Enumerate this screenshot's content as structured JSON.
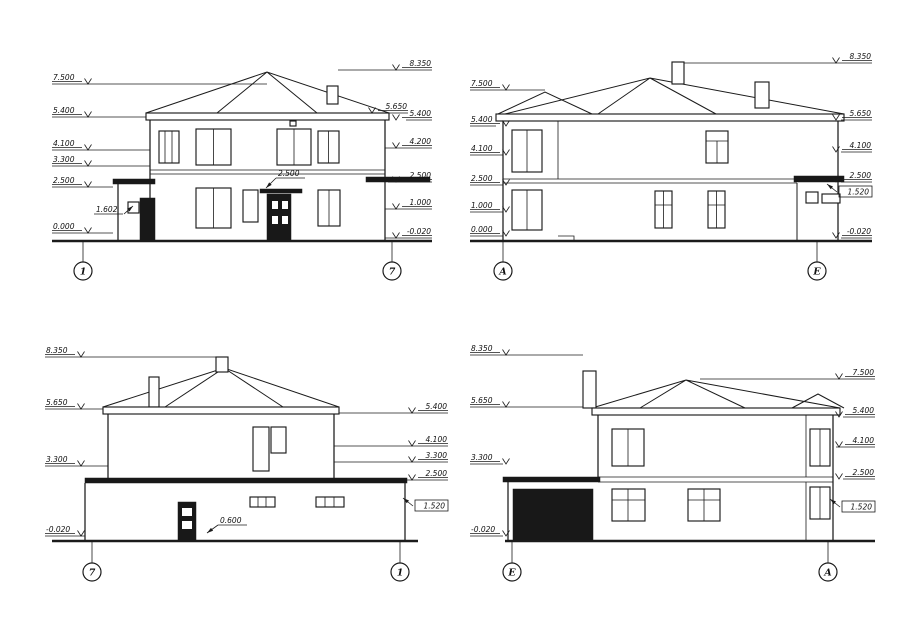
{
  "drawing": {
    "colors": {
      "line": "#1b1b1b",
      "background": "#ffffff"
    },
    "elevations": [
      {
        "id": "front-facade-1-7",
        "axes": [
          "1",
          "7"
        ],
        "marks_left": [
          "7.500",
          "5.400",
          "4.100",
          "3.300",
          "2.500",
          "0.000"
        ],
        "marks_right": [
          "8.350",
          "5.650",
          "5.400",
          "4.200",
          "2.500",
          "1.000",
          "-0.020"
        ],
        "notes": [
          "1.602",
          "2.500"
        ]
      },
      {
        "id": "side-facade-A-E",
        "axes": [
          "А",
          "Е"
        ],
        "marks_left": [
          "7.500",
          "5.400",
          "4.100",
          "2.500",
          "1.000",
          "0.000"
        ],
        "marks_right": [
          "8.350",
          "5.650",
          "4.100",
          "2.500",
          "1.520",
          "-0.020"
        ],
        "notes": []
      },
      {
        "id": "rear-facade-7-1",
        "axes": [
          "7",
          "1"
        ],
        "marks_left": [
          "8.350",
          "5.650",
          "3.300",
          "-0.020"
        ],
        "marks_right": [
          "5.400",
          "4.100",
          "3.300",
          "2.500",
          "1.520"
        ],
        "notes": [
          "0.600"
        ]
      },
      {
        "id": "side-facade-E-A",
        "axes": [
          "Е",
          "А"
        ],
        "marks_left": [
          "8.350",
          "5.650",
          "3.300",
          "-0.020"
        ],
        "marks_right": [
          "7.500",
          "5.400",
          "4.100",
          "2.500",
          "1.520"
        ],
        "notes": []
      }
    ]
  }
}
